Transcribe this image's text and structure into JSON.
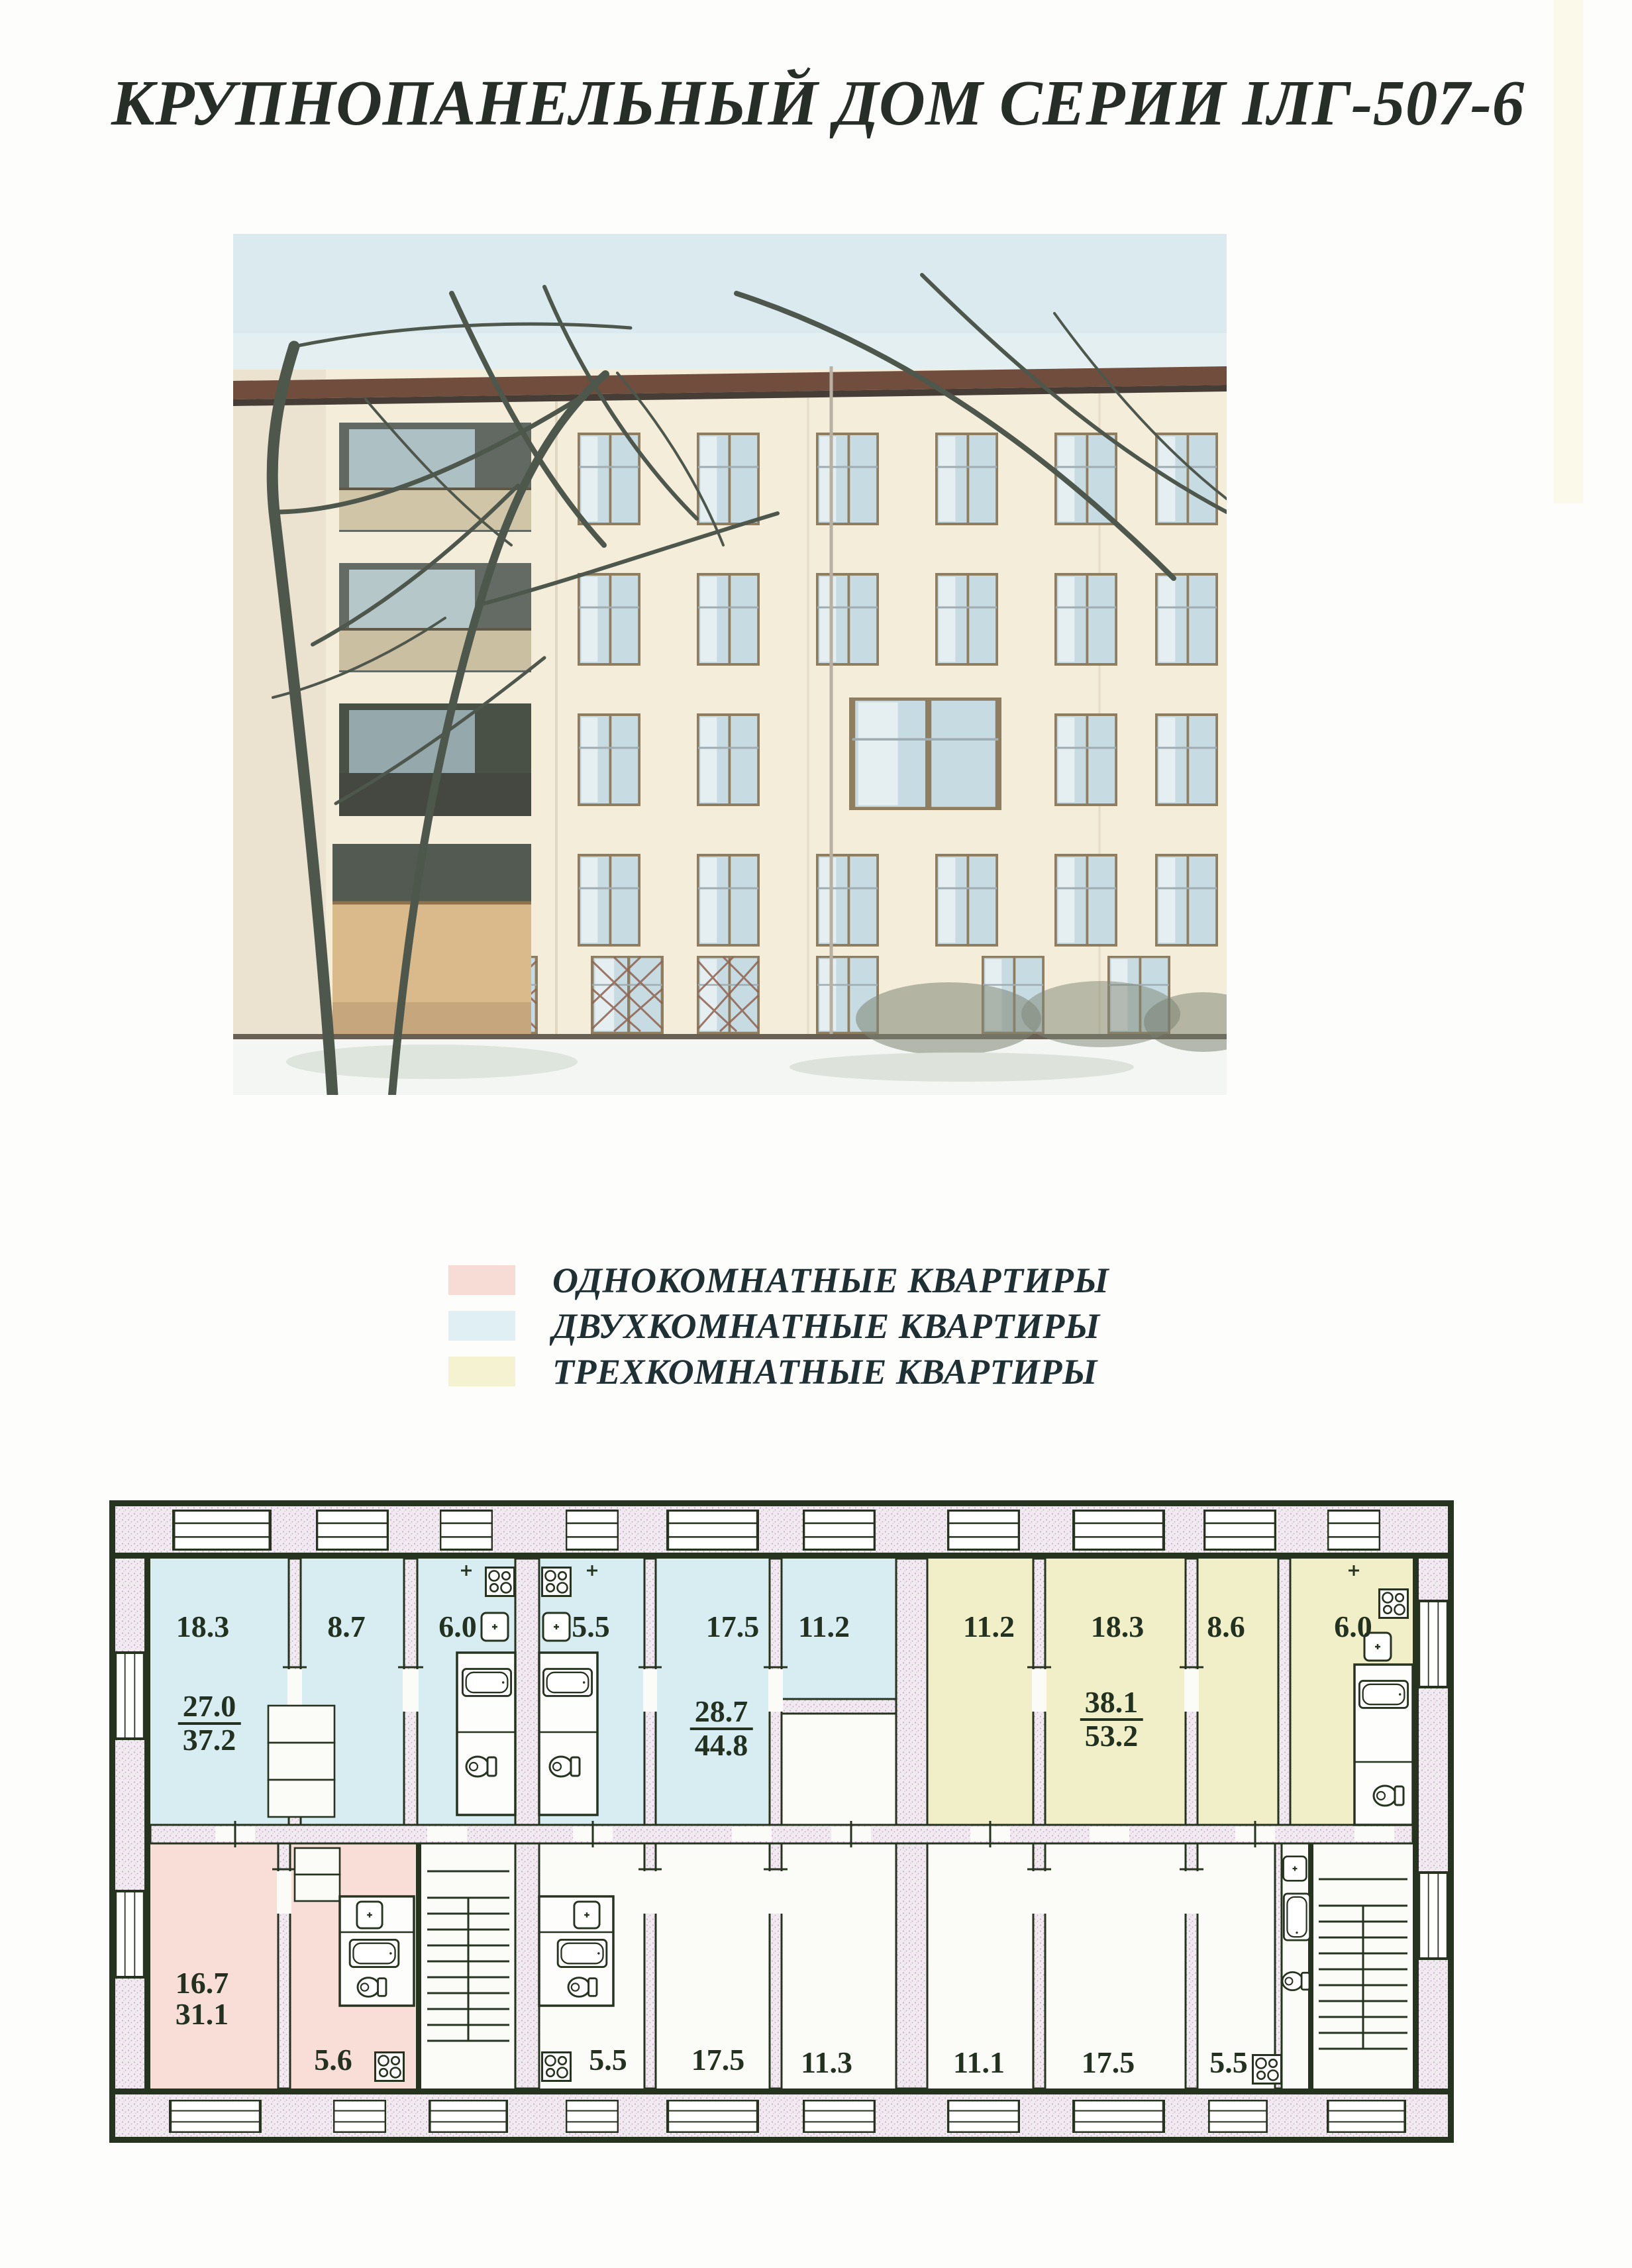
{
  "page": {
    "title": "КРУПНОПАНЕЛЬНЫЙ ДОМ СЕРИИ IЛГ-507-6"
  },
  "legend": {
    "items": [
      {
        "label": "ОДНОКОМНАТНЫЕ КВАРТИРЫ",
        "color": "#f7dcd6",
        "type": "one-room"
      },
      {
        "label": "ДВУХКОМНАТНЫЕ КВАРТИРЫ",
        "color": "#e0eff4",
        "type": "two-room"
      },
      {
        "label": "ТРЕХКОМНАТНЫЕ КВАРТИРЫ",
        "color": "#f5f2d2",
        "type": "three-room"
      }
    ]
  },
  "floor_plan": {
    "colors": {
      "one_room": "#f8ded7",
      "two_room": "#d8edf2",
      "three_room": "#f1efc8",
      "wall_fill": "#f2eaf1",
      "line": "#26331f",
      "room_white": "#fbfbf7"
    },
    "rooms_top": [
      {
        "area": "18.3",
        "type": "two-room"
      },
      {
        "area": "8.7",
        "type": "two-room"
      },
      {
        "area": "6.0",
        "type": "two-room"
      },
      {
        "area": "5.5",
        "type": "two-room"
      },
      {
        "area": "17.5",
        "type": "two-room"
      },
      {
        "area": "11.2",
        "type": "two-room"
      },
      {
        "area": "11.2",
        "type": "three-room"
      },
      {
        "area": "18.3",
        "type": "three-room"
      },
      {
        "area": "8.6",
        "type": "three-room"
      },
      {
        "area": "6.0",
        "type": "three-room"
      }
    ],
    "rooms_bottom": [
      {
        "area": "5.6"
      },
      {
        "area": "5.5"
      },
      {
        "area": "17.5"
      },
      {
        "area": "11.3"
      },
      {
        "area": "11.1"
      },
      {
        "area": "17.5"
      },
      {
        "area": "5.5"
      }
    ],
    "apartments": [
      {
        "living_area": "27.0",
        "total_area": "37.2"
      },
      {
        "living_area": "28.7",
        "total_area": "44.8"
      },
      {
        "living_area": "38.1",
        "total_area": "53.2"
      },
      {
        "living_area": "16.7",
        "total_area": "31.1"
      }
    ]
  }
}
